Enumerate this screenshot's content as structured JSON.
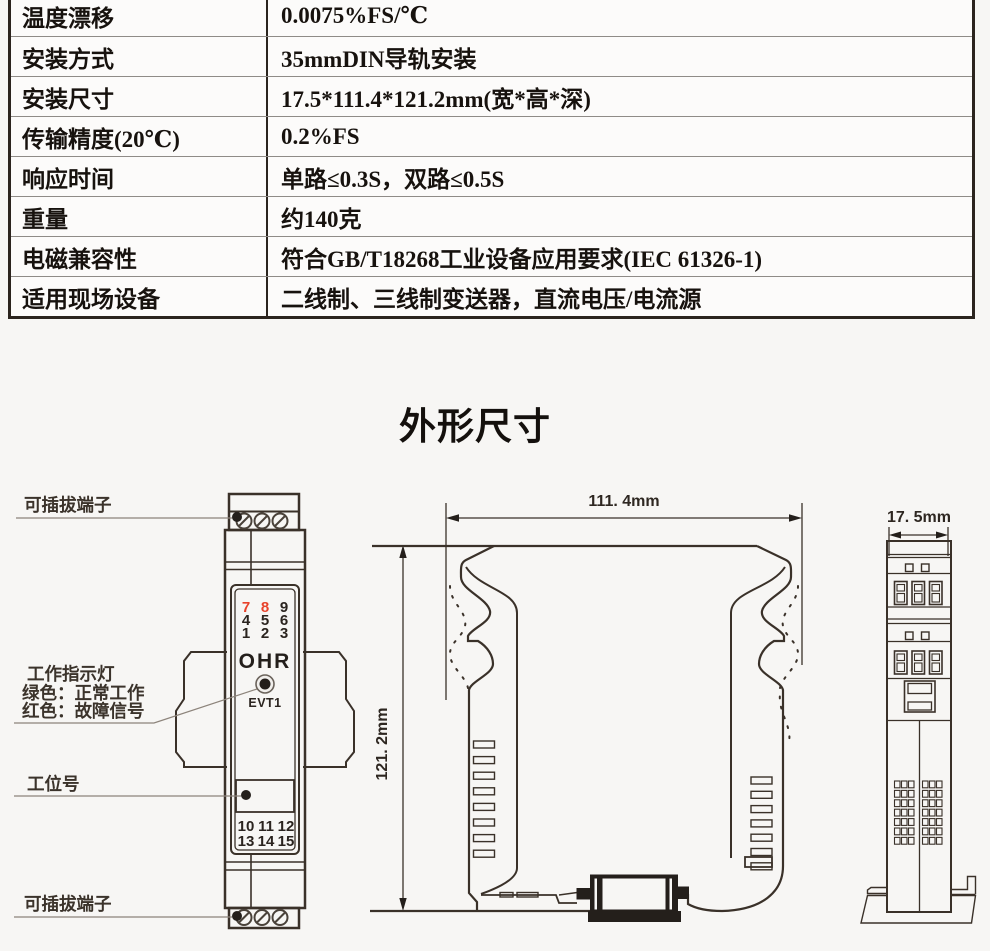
{
  "spec_table": {
    "rows": [
      {
        "label": "温度漂移",
        "value": "0.0075%FS/℃"
      },
      {
        "label": "安装方式",
        "value": "35mmDIN导轨安装"
      },
      {
        "label": "安装尺寸",
        "value": "17.5*111.4*121.2mm(宽*高*深)"
      },
      {
        "label": "传输精度(20℃)",
        "value": "0.2%FS"
      },
      {
        "label": "响应时间",
        "value": "单路≤0.3S，双路≤0.5S"
      },
      {
        "label": "重量",
        "value": "约140克"
      },
      {
        "label": "电磁兼容性",
        "value": "符合GB/T18268工业设备应用要求(IEC 61326-1)"
      },
      {
        "label": "适用现场设备",
        "value": "二线制、三线制变送器，直流电压/电流源"
      }
    ]
  },
  "section_title": "外形尺寸",
  "front_view": {
    "callouts": {
      "pluggable_terminal_top": "可插拔端子",
      "indicator_line1": "工作指示灯",
      "indicator_line2": "绿色：正常工作",
      "indicator_line3": "红色：故障信号",
      "station_number": "工位号",
      "pluggable_terminal_bottom": "可插拔端子"
    },
    "brand": "OHR",
    "led_label": "EVT1",
    "pin_rows": [
      [
        "7",
        "8",
        "9"
      ],
      [
        "4",
        "5",
        "6"
      ],
      [
        "1",
        "2",
        "3"
      ]
    ],
    "pin_rows_bottom": [
      [
        "10",
        "11",
        "12"
      ],
      [
        "13",
        "14",
        "15"
      ]
    ]
  },
  "side_view": {
    "width_dim": "111. 4mm",
    "height_dim": "121. 2mm"
  },
  "end_view": {
    "depth_dim": "17. 5mm"
  },
  "colors": {
    "line": "#3a3129",
    "red_pin": "#e8432b",
    "table_border": "#2b241e"
  }
}
